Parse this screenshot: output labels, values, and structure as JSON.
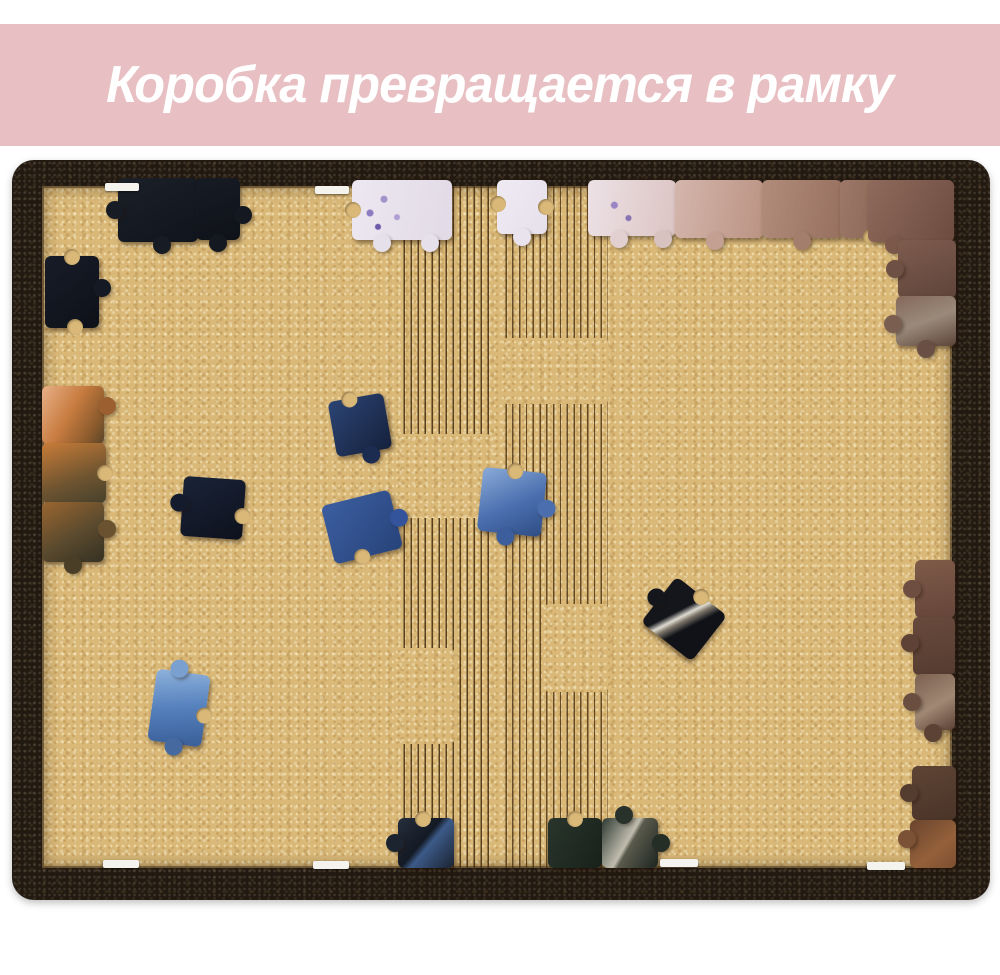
{
  "banner": {
    "text": "Коробка превращается в рамку",
    "bg_color": "#e8c0c3",
    "text_color": "#ffffff"
  },
  "photo": {
    "frame_color": "#221910",
    "board_color": "#d9b878",
    "pieces": [
      {
        "x": 106,
        "y": 18,
        "w": 80,
        "h": 64,
        "rot": 0,
        "bg": "linear-gradient(150deg,#1b2029,#10141c)",
        "knobs": [
          {
            "side": "bottom",
            "pos": 0.55,
            "type": "out",
            "color": "#161b24"
          },
          {
            "side": "left",
            "pos": 0.5,
            "type": "out",
            "color": "#161b24"
          }
        ]
      },
      {
        "x": 184,
        "y": 18,
        "w": 44,
        "h": 62,
        "rot": 0,
        "bg": "linear-gradient(160deg,#171b24,#0f1219)",
        "knobs": [
          {
            "side": "bottom",
            "pos": 0.5,
            "type": "out",
            "color": "#141820"
          },
          {
            "side": "right",
            "pos": 0.6,
            "type": "out",
            "color": "#141820"
          }
        ]
      },
      {
        "x": 33,
        "y": 96,
        "w": 54,
        "h": 72,
        "rot": 0,
        "bg": "linear-gradient(140deg,#171c28,#0e1118)",
        "knobs": [
          {
            "side": "right",
            "pos": 0.45,
            "type": "out",
            "color": "#141924"
          },
          {
            "side": "top",
            "pos": 0.5,
            "type": "in"
          },
          {
            "side": "bottom",
            "pos": 0.55,
            "type": "in"
          }
        ]
      },
      {
        "x": 30,
        "y": 226,
        "w": 62,
        "h": 58,
        "rot": 0,
        "bg": "linear-gradient(120deg,#e8b088,#c87c40 45%,#8a5a2c 80%,#5a452a)",
        "knobs": [
          {
            "side": "right",
            "pos": 0.35,
            "type": "out",
            "color": "#9c6030"
          }
        ]
      },
      {
        "x": 30,
        "y": 283,
        "w": 64,
        "h": 60,
        "rot": 0,
        "bg": "linear-gradient(160deg,#c87c38,#6e5430 60%,#46412c)",
        "knobs": [
          {
            "side": "right",
            "pos": 0.5,
            "type": "in"
          }
        ]
      },
      {
        "x": 30,
        "y": 342,
        "w": 62,
        "h": 60,
        "rot": 0,
        "bg": "linear-gradient(150deg,#9a6630,#5a4a2e 55%,#353122)",
        "knobs": [
          {
            "side": "right",
            "pos": 0.45,
            "type": "out",
            "color": "#6a5230"
          },
          {
            "side": "bottom",
            "pos": 0.5,
            "type": "out",
            "color": "#4a3e26"
          }
        ]
      },
      {
        "x": 340,
        "y": 20,
        "w": 100,
        "h": 60,
        "rot": 0,
        "bg": "radial-gradient(circle at 18% 55%, #8d7cc0 0 3px, transparent 4px),radial-gradient(circle at 32% 32%, #a393cc 0 3px, transparent 4px),radial-gradient(circle at 45% 62%, #b09ed4 0 2.5px, transparent 3.5px),radial-gradient(circle at 26% 78%, #6c5aa8 0 2.5px, transparent 3.5px),linear-gradient(100deg,#ece7f0,#e2dbe7)",
        "knobs": [
          {
            "side": "bottom",
            "pos": 0.3,
            "type": "out",
            "color": "#e6e0ea"
          },
          {
            "side": "bottom",
            "pos": 0.78,
            "type": "out",
            "color": "#e6e0ea"
          },
          {
            "side": "left",
            "pos": 0.5,
            "type": "in"
          }
        ]
      },
      {
        "x": 485,
        "y": 20,
        "w": 50,
        "h": 54,
        "rot": 0,
        "bg": "linear-gradient(120deg,#efeaf2,#e6e0ec)",
        "knobs": [
          {
            "side": "bottom",
            "pos": 0.5,
            "type": "out",
            "color": "#e8e3ec"
          },
          {
            "side": "left",
            "pos": 0.45,
            "type": "in"
          },
          {
            "side": "right",
            "pos": 0.5,
            "type": "in"
          }
        ]
      },
      {
        "x": 576,
        "y": 20,
        "w": 88,
        "h": 56,
        "rot": 0,
        "bg": "radial-gradient(circle at 30% 45%, #9a86c4 0 3px, transparent 4px),radial-gradient(circle at 46% 68%, #8673b4 0 2.5px, transparent 3.5px),linear-gradient(100deg,#ece1e6,#dcc4c2)",
        "knobs": [
          {
            "side": "bottom",
            "pos": 0.35,
            "type": "out",
            "color": "#e2d0d0"
          },
          {
            "side": "bottom",
            "pos": 0.85,
            "type": "out",
            "color": "#d8c2c0"
          }
        ]
      },
      {
        "x": 663,
        "y": 20,
        "w": 88,
        "h": 58,
        "rot": 0,
        "bg": "linear-gradient(100deg,#d4b6ac,#bb9383)",
        "knobs": [
          {
            "side": "bottom",
            "pos": 0.45,
            "type": "out",
            "color": "#c4a093"
          }
        ]
      },
      {
        "x": 750,
        "y": 20,
        "w": 80,
        "h": 58,
        "rot": 0,
        "bg": "linear-gradient(100deg,#b28c7a,#97705f)",
        "knobs": [
          {
            "side": "bottom",
            "pos": 0.5,
            "type": "out",
            "color": "#a37e6c"
          }
        ]
      },
      {
        "x": 828,
        "y": 20,
        "w": 62,
        "h": 58,
        "rot": 0,
        "bg": "linear-gradient(100deg,#9d7868,#82604f)",
        "knobs": [
          {
            "side": "bottom",
            "pos": 0.5,
            "type": "in"
          }
        ]
      },
      {
        "x": 856,
        "y": 20,
        "w": 86,
        "h": 62,
        "rot": 0,
        "bg": "linear-gradient(120deg,#8f6a5c,#6d4c40)",
        "knobs": [
          {
            "side": "bottom",
            "pos": 0.3,
            "type": "out",
            "color": "#7c584a"
          }
        ]
      },
      {
        "x": 886,
        "y": 80,
        "w": 58,
        "h": 58,
        "rot": 0,
        "bg": "linear-gradient(160deg,#7e5c4e,#5f443a)",
        "knobs": [
          {
            "side": "left",
            "pos": 0.5,
            "type": "out",
            "color": "#6e5044"
          }
        ]
      },
      {
        "x": 884,
        "y": 136,
        "w": 60,
        "h": 50,
        "rot": 0,
        "bg": "linear-gradient(160deg,#85685a,#9a8a7a 50%,#5c4438)",
        "knobs": [
          {
            "side": "left",
            "pos": 0.55,
            "type": "out",
            "color": "#7a5e50"
          },
          {
            "side": "bottom",
            "pos": 0.5,
            "type": "out",
            "color": "#6a5044"
          }
        ]
      },
      {
        "x": 903,
        "y": 400,
        "w": 40,
        "h": 58,
        "rot": 0,
        "bg": "linear-gradient(170deg,#7e5a48,#66453a)",
        "knobs": [
          {
            "side": "left",
            "pos": 0.5,
            "type": "out",
            "color": "#6e4e40"
          }
        ]
      },
      {
        "x": 901,
        "y": 457,
        "w": 42,
        "h": 58,
        "rot": 0,
        "bg": "linear-gradient(170deg,#684a3c,#553c30)",
        "knobs": [
          {
            "side": "left",
            "pos": 0.45,
            "type": "out",
            "color": "#5e4236"
          }
        ]
      },
      {
        "x": 903,
        "y": 514,
        "w": 40,
        "h": 56,
        "rot": 0,
        "bg": "linear-gradient(150deg,#7c6050,#a08874 55%,#5a4034)",
        "knobs": [
          {
            "side": "left",
            "pos": 0.5,
            "type": "out",
            "color": "#6a4e40"
          },
          {
            "side": "bottom",
            "pos": 0.45,
            "type": "out",
            "color": "#5c4234"
          }
        ]
      },
      {
        "x": 900,
        "y": 606,
        "w": 44,
        "h": 54,
        "rot": 0,
        "bg": "linear-gradient(160deg,#5e4434,#4a3428)",
        "knobs": [
          {
            "side": "left",
            "pos": 0.5,
            "type": "out",
            "color": "#543c2e"
          }
        ]
      },
      {
        "x": 898,
        "y": 660,
        "w": 46,
        "h": 48,
        "rot": 0,
        "bg": "linear-gradient(140deg,#6a452e,#94603a 60%,#7c4e30)",
        "knobs": [
          {
            "side": "left",
            "pos": 0.4,
            "type": "out",
            "color": "#7c5236"
          }
        ]
      },
      {
        "x": 386,
        "y": 658,
        "w": 56,
        "h": 50,
        "rot": 0,
        "bg": "linear-gradient(130deg,#252e3c,#141a24 45%,#3c5a88 55%,#1a2230)",
        "knobs": [
          {
            "side": "left",
            "pos": 0.5,
            "type": "out",
            "color": "#1c2430"
          },
          {
            "side": "top",
            "pos": 0.45,
            "type": "in"
          }
        ]
      },
      {
        "x": 536,
        "y": 658,
        "w": 54,
        "h": 50,
        "rot": 0,
        "bg": "linear-gradient(120deg,#29352c,#18211a)",
        "knobs": [
          {
            "side": "top",
            "pos": 0.5,
            "type": "in"
          }
        ]
      },
      {
        "x": 590,
        "y": 658,
        "w": 56,
        "h": 50,
        "rot": 0,
        "bg": "linear-gradient(120deg,#2c3830,#c0bcae 46%,#5a5a4c 52%,#1c2420)",
        "knobs": [
          {
            "side": "top",
            "pos": 0.4,
            "type": "out",
            "color": "#28322a"
          },
          {
            "side": "right",
            "pos": 0.5,
            "type": "out",
            "color": "#242e26"
          }
        ]
      },
      {
        "x": 320,
        "y": 237,
        "w": 56,
        "h": 56,
        "rot": -10,
        "bg": "linear-gradient(140deg,#2c4474,#15213c)",
        "knobs": [
          {
            "side": "top",
            "pos": 0.4,
            "type": "in"
          },
          {
            "side": "bottom",
            "pos": 0.6,
            "type": "out",
            "color": "#1c2c50"
          }
        ]
      },
      {
        "x": 170,
        "y": 318,
        "w": 62,
        "h": 60,
        "rot": 4,
        "bg": "linear-gradient(150deg,#1a2338,#0d111c)",
        "knobs": [
          {
            "side": "left",
            "pos": 0.45,
            "type": "out",
            "color": "#141b2c"
          },
          {
            "side": "right",
            "pos": 0.6,
            "type": "in"
          }
        ]
      },
      {
        "x": 315,
        "y": 337,
        "w": 70,
        "h": 60,
        "rot": -14,
        "bg": "linear-gradient(140deg,#3c5ea0,#27437a)",
        "knobs": [
          {
            "side": "right",
            "pos": 0.5,
            "type": "out",
            "color": "#33539a"
          },
          {
            "side": "bottom",
            "pos": 0.4,
            "type": "in"
          }
        ]
      },
      {
        "x": 468,
        "y": 310,
        "w": 64,
        "h": 64,
        "rot": 6,
        "bg": "linear-gradient(150deg,#8aabd8,#4a6eae 55%,#2f4d84)",
        "knobs": [
          {
            "side": "top",
            "pos": 0.5,
            "type": "in"
          },
          {
            "side": "right",
            "pos": 0.55,
            "type": "out",
            "color": "#4a6eae"
          },
          {
            "side": "bottom",
            "pos": 0.45,
            "type": "out",
            "color": "#3c5e9c"
          }
        ]
      },
      {
        "x": 640,
        "y": 430,
        "w": 64,
        "h": 58,
        "rot": 38,
        "bg": "linear-gradient(115deg,#14161c 38%,#e0dcd2 46%,#7c7468 52%,#101218 62%)",
        "knobs": [
          {
            "side": "left",
            "pos": 0.5,
            "type": "out",
            "color": "#14161c"
          },
          {
            "side": "top",
            "pos": 0.5,
            "type": "in"
          }
        ]
      },
      {
        "x": 140,
        "y": 512,
        "w": 54,
        "h": 72,
        "rot": 8,
        "bg": "linear-gradient(170deg,#8fb2dc,#5480bc 50%,#3a5e98)",
        "knobs": [
          {
            "side": "top",
            "pos": 0.4,
            "type": "out",
            "color": "#7aa0d0"
          },
          {
            "side": "right",
            "pos": 0.55,
            "type": "in"
          },
          {
            "side": "bottom",
            "pos": 0.5,
            "type": "out",
            "color": "#46699f"
          }
        ]
      }
    ],
    "tabs": [
      {
        "x": 93,
        "y": 23,
        "w": 34,
        "h": 8
      },
      {
        "x": 303,
        "y": 26,
        "w": 34,
        "h": 8
      },
      {
        "x": 91,
        "y": 700,
        "w": 36,
        "h": 8
      },
      {
        "x": 301,
        "y": 701,
        "w": 36,
        "h": 8
      },
      {
        "x": 648,
        "y": 699,
        "w": 38,
        "h": 8
      },
      {
        "x": 855,
        "y": 702,
        "w": 38,
        "h": 8
      }
    ]
  }
}
